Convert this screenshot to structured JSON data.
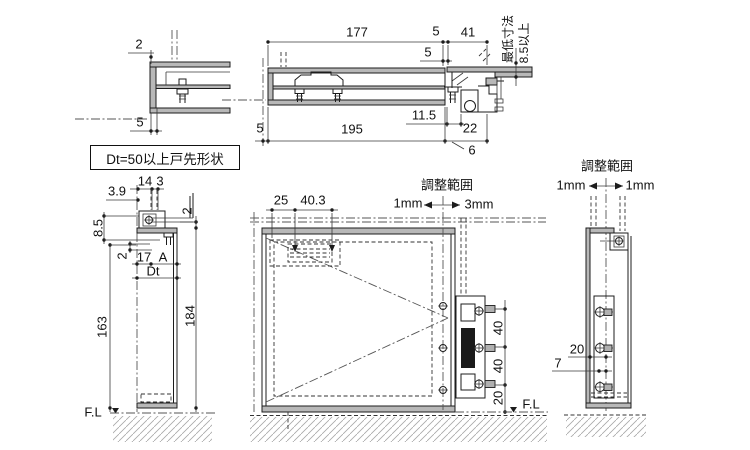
{
  "drawing": {
    "background": "#ffffff",
    "line_color": "#1c1c1c",
    "steel_fill": "#b8b8b8",
    "hatch_color": "#9a9a9a",
    "note_box": "Dt=50以上戸先形状",
    "corner_detail": {
      "dim_top": "2",
      "dim_bottom": "5"
    },
    "head_section": {
      "dim_width": "177",
      "dim_gap_top": "5",
      "dim_depth": "41",
      "dim_gap_side": "5",
      "dim_offset": "11.5",
      "dim_left": "5",
      "dim_total": "195",
      "dim_edge": "22",
      "dim_lip": "6",
      "min_label": "最低寸法",
      "min_value": "8.5以上"
    },
    "edge_section": {
      "dim_39": "3.9",
      "dim_14": "14",
      "dim_3": "3",
      "dim_85": "8.5",
      "dim_2_left": "2",
      "dim_17": "17",
      "dim_a": "A",
      "dim_dt": "Dt",
      "dim_2_right": "2",
      "dim_163": "163",
      "dim_184": "184",
      "floor": "F.L"
    },
    "elevation": {
      "dim_25": "25",
      "dim_403": "40.3",
      "adjust_title": "調整範囲",
      "adjust_min": "1mm",
      "adjust_max": "3mm",
      "dim_40a": "40",
      "dim_40b": "40",
      "dim_20": "20",
      "floor": "F.L"
    },
    "jamb_section": {
      "adjust_title": "調整範囲",
      "adjust_min": "1mm",
      "adjust_max": "1mm",
      "dim_20": "20",
      "dim_7": "7"
    }
  }
}
